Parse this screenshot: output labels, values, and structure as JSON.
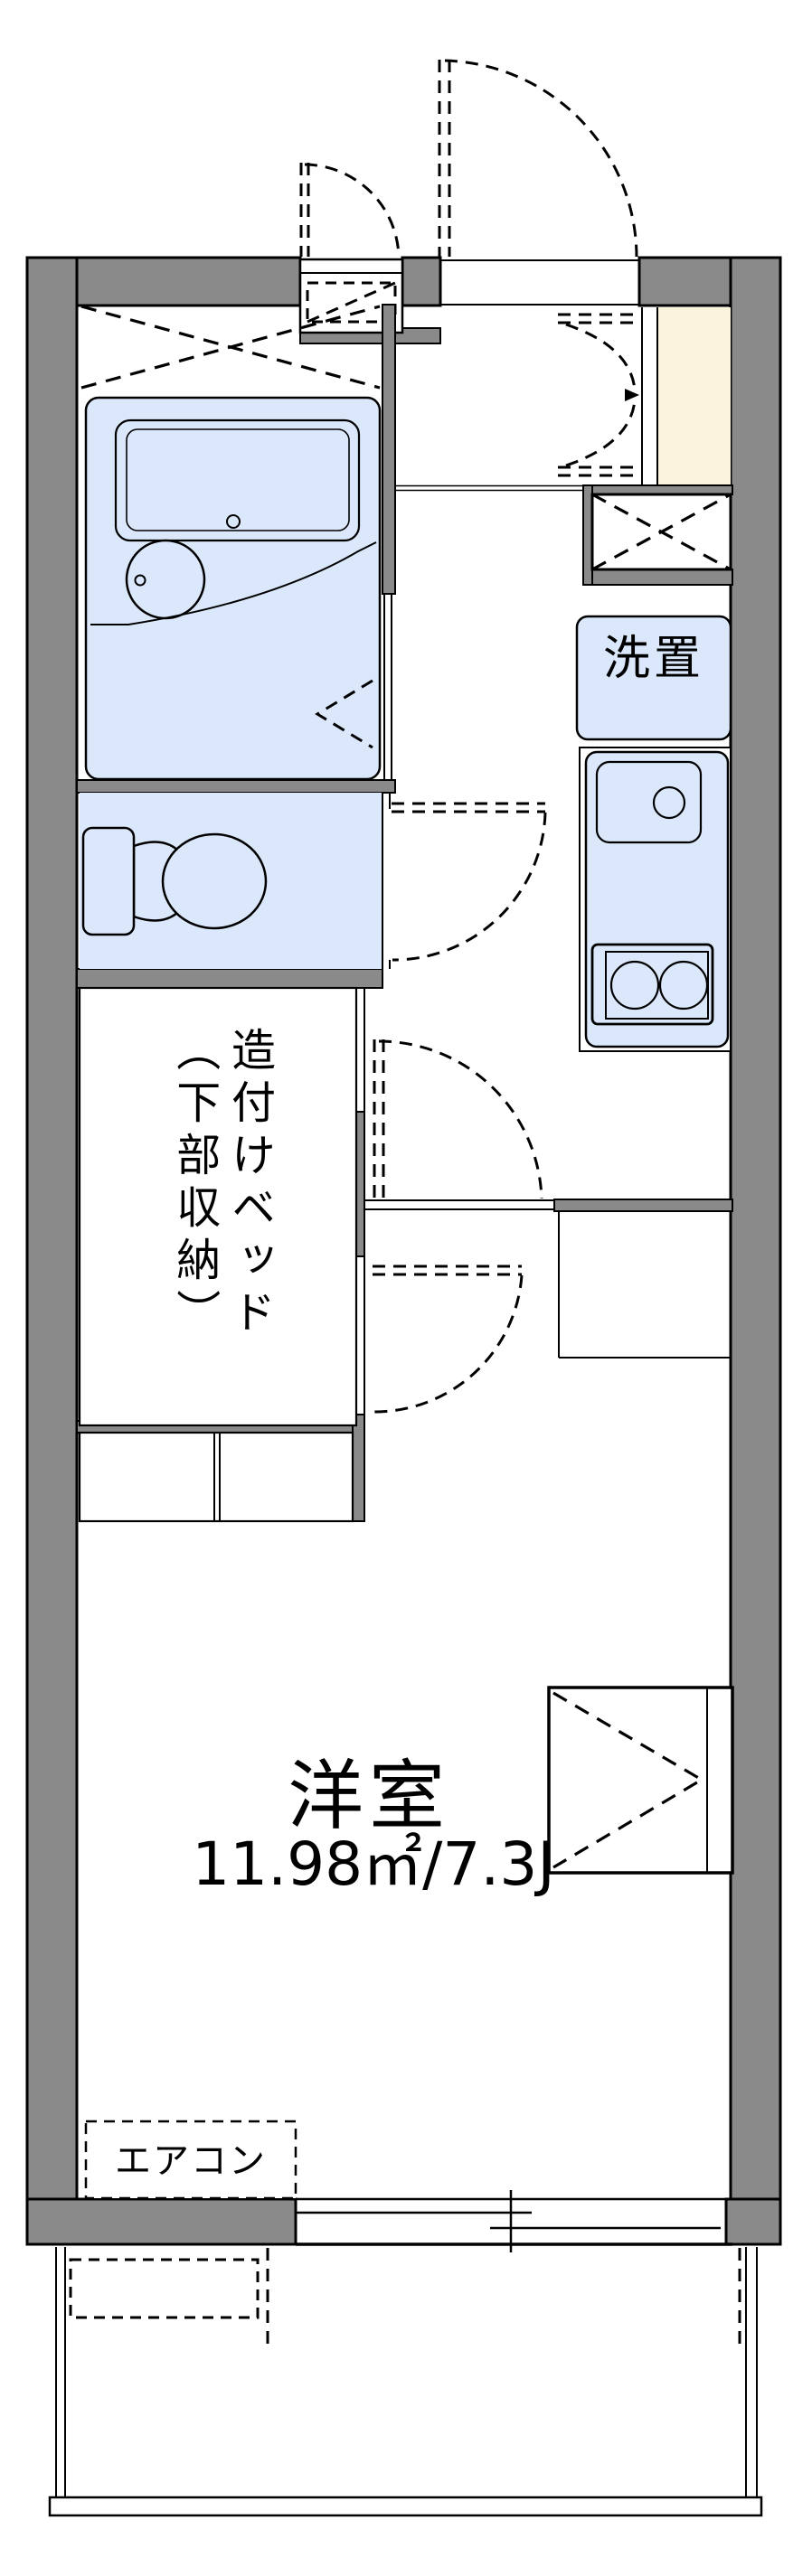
{
  "page": {
    "kind": "japanese-apartment-floor-plan"
  },
  "colors": {
    "wall": "#8a8a8a",
    "line": "#000000",
    "water": "#dbe8fb",
    "genkan": "#fcf3dc",
    "paper": "#ffffff"
  },
  "rooms": {
    "western_room": {
      "name": "洋室",
      "size": "11.98㎡/7.3J"
    },
    "built_in_bed": {
      "line1": "造付けベッド",
      "line2": "（下部収納）"
    },
    "laundry": {
      "label": "洗置"
    },
    "aircon": {
      "label": "エアコン"
    }
  }
}
